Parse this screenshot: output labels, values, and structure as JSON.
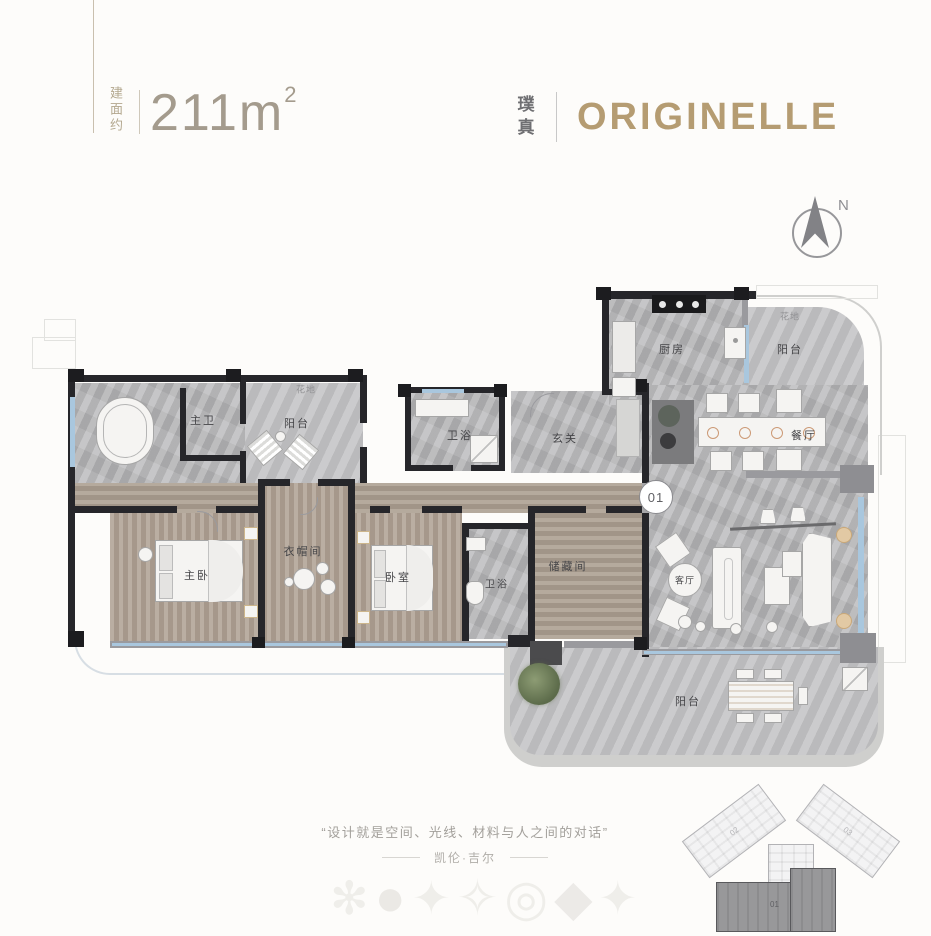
{
  "header": {
    "area_prefix": "建面约",
    "area_value": "211m",
    "area_sup": "2",
    "brand_cn": "璞真",
    "brand_en": "ORIGINELLE",
    "compass_n": "N"
  },
  "plan": {
    "unit_badge": "01",
    "labels": {
      "master_bath": "主卫",
      "balcony_left": "阳台",
      "flower_bed_left": "花地",
      "bath_1": "卫浴",
      "foyer": "玄关",
      "kitchen": "厨房",
      "balcony_top": "阳台",
      "flower_bed_top": "花地",
      "dining": "餐厅",
      "master_bedroom": "主卧",
      "closet": "衣帽间",
      "bedroom": "卧室",
      "bath_2": "卫浴",
      "storage": "储藏间",
      "living": "客厅",
      "balcony_bottom": "阳台"
    }
  },
  "footer": {
    "quote": "“设计就是空间、光线、材料与人之间的对话”",
    "attribution": "凯伦·吉尔",
    "watermarks": [
      "✻",
      "●",
      "✦",
      "✧",
      "◎",
      "◆",
      "✦"
    ]
  },
  "keyplan": {
    "unit_01": "01",
    "unit_02": "02",
    "unit_03": "03"
  },
  "colors": {
    "brand_gold": "#b59c72",
    "area_text": "#a49b8d",
    "plan_text": "#454548",
    "wall_dark": "#26262a",
    "wall_gray": "#9a9a9e",
    "marble_floor": "#b6b6b8",
    "wood_floor": "#b0a294",
    "window_blue": "#a9c7de",
    "keyplan_highlight": "#98989a"
  }
}
